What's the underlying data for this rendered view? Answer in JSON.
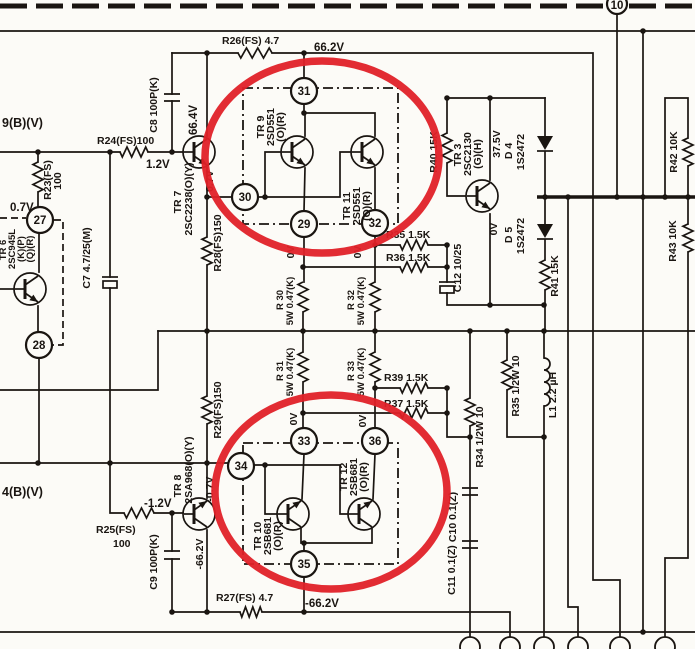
{
  "schematic": {
    "colors": {
      "ink": "#1a1511",
      "paper": "#fcfbf7",
      "highlight": "#e02128"
    },
    "wires": {
      "left_top": "9(B)(V)",
      "left_bottom": "4(B)(V)"
    },
    "pins": {
      "p10": "10",
      "p27": "27",
      "p28": "28",
      "p29": "29",
      "p30": "30",
      "p31": "31",
      "p32": "32",
      "p33": "33",
      "p34": "34",
      "p35": "35",
      "p36": "36"
    },
    "tr": {
      "tr3": [
        "TR 3",
        "2SC2130",
        "(G)(H)"
      ],
      "tr6": [
        "TR 6",
        "2SC945L",
        "(K)(P)",
        "(Q)(R)"
      ],
      "tr7": [
        "TR 7",
        "2SC2238(O)(Y)"
      ],
      "tr8": [
        "TR 8",
        "2SA968(O)(Y)"
      ],
      "tr9": [
        "TR 9",
        "2SD551",
        "(O)(R)"
      ],
      "tr10": [
        "TR 10",
        "2SB681",
        "(O)(R)"
      ],
      "tr11": [
        "TR 11",
        "2SD551",
        "(O)(R)"
      ],
      "tr12": [
        "TR 12",
        "2SB681",
        "(O)(R)"
      ]
    },
    "res": {
      "r23": [
        "R23(FS)",
        "100"
      ],
      "r24": "R24(FS)100",
      "r25": [
        "R25(FS)",
        "100"
      ],
      "r26": "R26(FS) 4.7",
      "r27": "R27(FS) 4.7",
      "r28": "R28(FS)150",
      "r29": "R29(FS)150",
      "r30": [
        "R 30",
        "5W 0.47(K)"
      ],
      "r31": [
        "R 31",
        "5W 0.47(K)"
      ],
      "r32": [
        "R 32",
        "5W 0.47(K)"
      ],
      "r33": [
        "R 33",
        "5W 0.47(K)"
      ],
      "r34": "R34 1/2W 10",
      "r35": "R35 1.5K",
      "r35b": "R35 1/2W 10",
      "r36": "R36 1.5K",
      "r37": "R37 1.5K",
      "r39": "R39 1.5K",
      "r40": "R40 15K",
      "r41": "R41 15K",
      "r42": "R42 10K",
      "r43": "R43 10K"
    },
    "cap": {
      "c7": "C7 4.7/25(M)",
      "c8": "C8 100P(K)",
      "c9": "C9 100P(K)",
      "c10": "C10 0.1(Z)",
      "c11": "C11 0.1(Z)",
      "c12": "C12 10/25"
    },
    "d": {
      "d4": [
        "D 4",
        "1S2472"
      ],
      "d5": [
        "D 5",
        "1S2472"
      ]
    },
    "ind": {
      "l1": "L1 2.2 µH"
    },
    "volt": {
      "v662": "66.2V",
      "v664": "66.4V",
      "v12": "1.2V",
      "v07": "0.7V",
      "v375": "37.5V",
      "v0": "0V",
      "vm12": "-1.2V",
      "vm07": "-0.7V",
      "vm662": "-66.2V"
    }
  }
}
